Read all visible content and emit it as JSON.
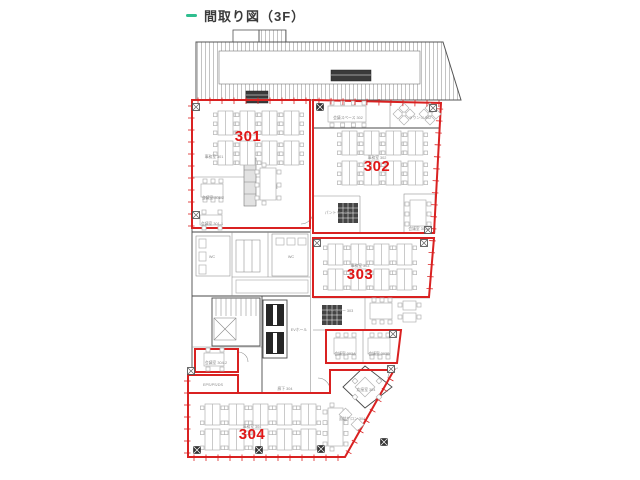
{
  "header": {
    "title": "間取り図（3F）",
    "accent_color": "#2fbe8f"
  },
  "colors": {
    "room_outline": "#d92121",
    "room_number": "#e01616",
    "walls": "#4a4a4a"
  },
  "rooms": {
    "r301": {
      "number": "301",
      "name": "事務室 301"
    },
    "r302": {
      "number": "302",
      "name": "事務室 302"
    },
    "r303": {
      "number": "303",
      "name": "事務室 303"
    },
    "r304": {
      "number": "304",
      "name": "事務室 304"
    }
  },
  "labels": {
    "eps": "EPS/PS/DS",
    "ev_hall": "EVホール",
    "wc_left": "WC",
    "wc_right": "WC",
    "meeting_301_2": "会議室 301-2",
    "meeting_301_1": "会議室 301-1",
    "meeting_space_302": "会議スペース 302",
    "lounge_302": "ラウンジ 302",
    "meeting_302a": "会議室 302A",
    "pantry_302": "パントリー 302",
    "pantry_303": "パントリー 303",
    "meeting_303a": "会議室 303A",
    "meeting_303b": "会議室 303B",
    "meeting_304_2": "会議室 304-2",
    "reception_304": "応接室 304",
    "salon_304": "面談サロン 304",
    "corridor_304": "廊下 304"
  }
}
